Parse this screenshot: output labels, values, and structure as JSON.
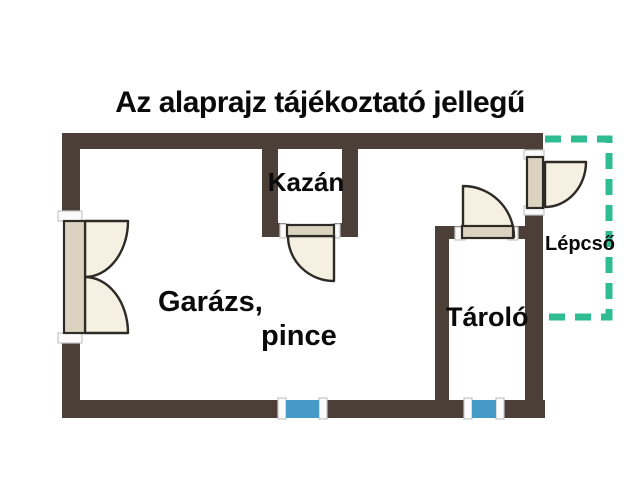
{
  "title": "Az alaprajz tájékoztató jellegű",
  "floorplan": {
    "labels": {
      "kazan": "Kazán",
      "garazs_line1": "Garázs,",
      "garazs_line2": "pince",
      "tarolo": "Tároló",
      "lepcso": "Lépcső"
    },
    "features": {
      "doors": [
        "garage-double-door",
        "kazan-door",
        "tarolo-door",
        "lepcso-door"
      ],
      "windows": 2,
      "stairs_area": "dashed outline right side"
    }
  },
  "colors": {
    "wall": "#4b3f37",
    "door_fill": "#f5f0e2",
    "door_panel": "#dbd3c0",
    "door_outline": "#2e2a26",
    "window": "#459ac8",
    "stairs_dash": "#2fbc93",
    "text": "#0a0a0a"
  }
}
